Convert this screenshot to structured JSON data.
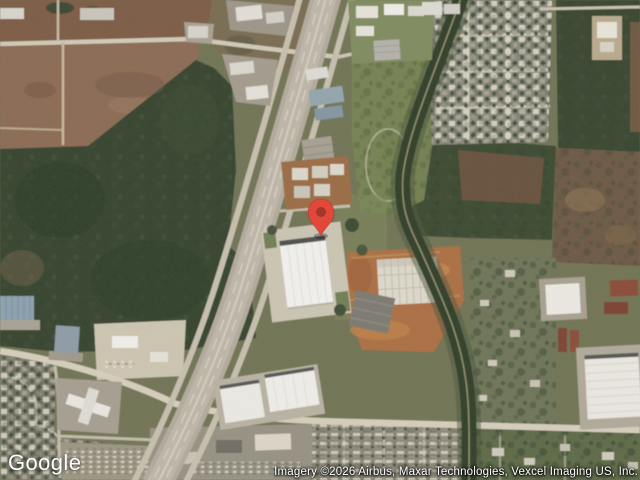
{
  "map": {
    "provider_logo": "Google",
    "attribution": "Imagery ©2026 Airbus, Maxar Technologies, Vexcel Imaging US, Inc.",
    "view_type": "satellite",
    "marker": {
      "name": "dropped-pin",
      "color": "#E2473A",
      "inner_color": "#A33529"
    }
  }
}
